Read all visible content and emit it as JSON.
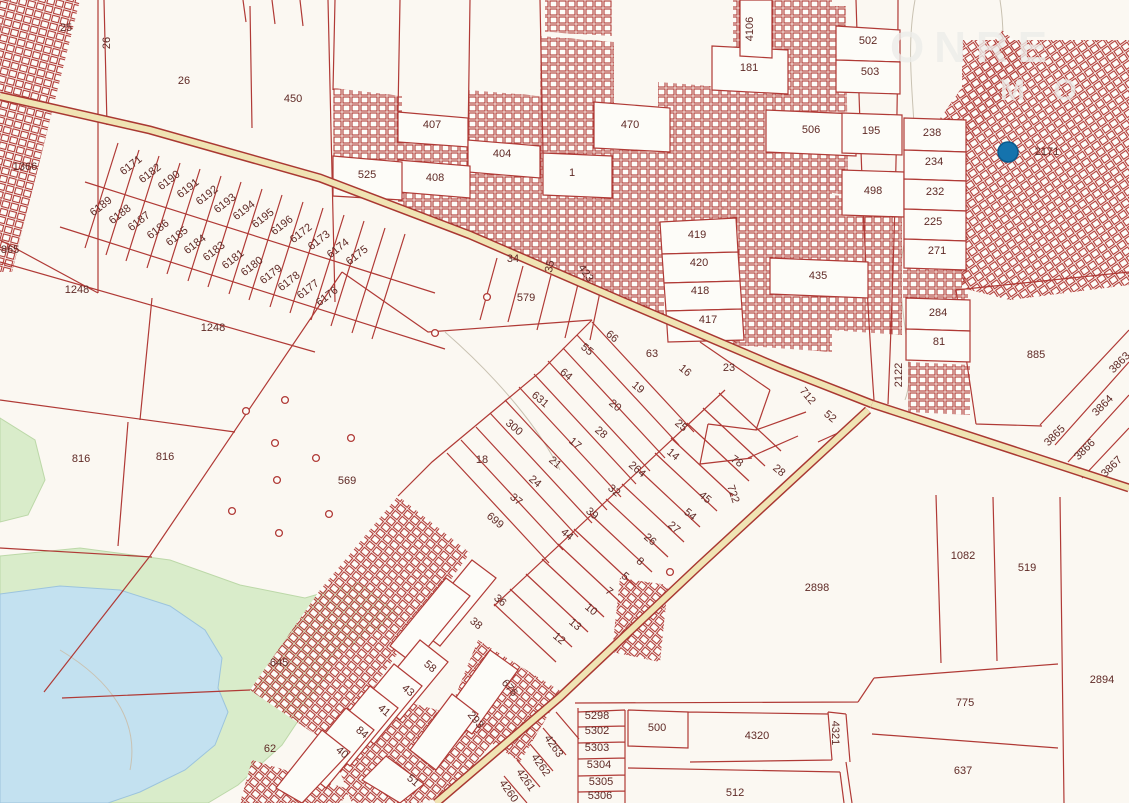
{
  "map": {
    "colors": {
      "background": "#fbf8f2",
      "parcel_line": "#b03a36",
      "label_text": "#5f2a26",
      "road_fill": "#f0e4b4",
      "road_casing": "#a93832",
      "water": "#c3e1f0",
      "vegetation": "#d9ecca",
      "marker_blue": "#1573ad"
    },
    "watermark": {
      "line1": "ONRE",
      "line2": "M O"
    },
    "marker": {
      "x": 1008,
      "y": 152,
      "r": 10,
      "color": "#1573ad"
    },
    "survey_circles": [
      [
        246,
        411
      ],
      [
        285,
        400
      ],
      [
        275,
        443
      ],
      [
        351,
        438
      ],
      [
        316,
        458
      ],
      [
        277,
        480
      ],
      [
        232,
        511
      ],
      [
        329,
        514
      ],
      [
        279,
        533
      ],
      [
        487,
        297
      ],
      [
        670,
        572
      ],
      [
        435,
        333
      ]
    ],
    "labels": [
      {
        "t": "25",
        "x": 66,
        "y": 31
      },
      {
        "t": "26",
        "x": 110,
        "y": 43,
        "r": -90
      },
      {
        "t": "26",
        "x": 184,
        "y": 84
      },
      {
        "t": "450",
        "x": 293,
        "y": 102
      },
      {
        "t": "1366",
        "x": 25,
        "y": 170
      },
      {
        "t": "865",
        "x": 10,
        "y": 253
      },
      {
        "t": "1248",
        "x": 77,
        "y": 293
      },
      {
        "t": "1248",
        "x": 213,
        "y": 331
      },
      {
        "t": "816",
        "x": 81,
        "y": 462
      },
      {
        "t": "816",
        "x": 165,
        "y": 460
      },
      {
        "t": "569",
        "x": 347,
        "y": 484
      },
      {
        "t": "645",
        "x": 279,
        "y": 666
      },
      {
        "t": "62",
        "x": 270,
        "y": 752
      },
      {
        "t": "525",
        "x": 367,
        "y": 178
      },
      {
        "t": "407",
        "x": 432,
        "y": 128
      },
      {
        "t": "404",
        "x": 502,
        "y": 157
      },
      {
        "t": "408",
        "x": 435,
        "y": 181
      },
      {
        "t": "470",
        "x": 630,
        "y": 128
      },
      {
        "t": "1",
        "x": 572,
        "y": 176
      },
      {
        "t": "34",
        "x": 513,
        "y": 262
      },
      {
        "t": "35",
        "x": 553,
        "y": 267,
        "r": -78
      },
      {
        "t": "423",
        "x": 583,
        "y": 275,
        "r": 55
      },
      {
        "t": "579",
        "x": 526,
        "y": 301
      },
      {
        "t": "4106",
        "x": 753,
        "y": 29,
        "r": -90
      },
      {
        "t": "181",
        "x": 749,
        "y": 71
      },
      {
        "t": "502",
        "x": 868,
        "y": 44
      },
      {
        "t": "503",
        "x": 870,
        "y": 75
      },
      {
        "t": "506",
        "x": 811,
        "y": 133
      },
      {
        "t": "195",
        "x": 871,
        "y": 134
      },
      {
        "t": "498",
        "x": 873,
        "y": 194
      },
      {
        "t": "238",
        "x": 932,
        "y": 136
      },
      {
        "t": "234",
        "x": 934,
        "y": 165
      },
      {
        "t": "232",
        "x": 935,
        "y": 195
      },
      {
        "t": "225",
        "x": 933,
        "y": 225
      },
      {
        "t": "271",
        "x": 937,
        "y": 254
      },
      {
        "t": "284",
        "x": 938,
        "y": 316
      },
      {
        "t": "81",
        "x": 939,
        "y": 345
      },
      {
        "t": "2122",
        "x": 902,
        "y": 375,
        "r": -90
      },
      {
        "t": "885",
        "x": 1036,
        "y": 358
      },
      {
        "t": "3863",
        "x": 1122,
        "y": 365,
        "r": -45
      },
      {
        "t": "3864",
        "x": 1105,
        "y": 408,
        "r": -45
      },
      {
        "t": "3865",
        "x": 1057,
        "y": 438,
        "r": -45
      },
      {
        "t": "3866",
        "x": 1087,
        "y": 452,
        "r": -45
      },
      {
        "t": "3867",
        "x": 1114,
        "y": 469,
        "r": -45
      },
      {
        "t": "2171",
        "x": 1047,
        "y": 155
      },
      {
        "t": "419",
        "x": 697,
        "y": 238
      },
      {
        "t": "420",
        "x": 699,
        "y": 266
      },
      {
        "t": "418",
        "x": 700,
        "y": 294
      },
      {
        "t": "417",
        "x": 708,
        "y": 323
      },
      {
        "t": "435",
        "x": 818,
        "y": 279
      },
      {
        "t": "66",
        "x": 610,
        "y": 339,
        "r": 40
      },
      {
        "t": "55",
        "x": 585,
        "y": 352,
        "r": 40
      },
      {
        "t": "63",
        "x": 652,
        "y": 357
      },
      {
        "t": "64",
        "x": 564,
        "y": 377,
        "r": 40
      },
      {
        "t": "16",
        "x": 683,
        "y": 373,
        "r": 40
      },
      {
        "t": "19",
        "x": 636,
        "y": 390,
        "r": 40
      },
      {
        "t": "23",
        "x": 729,
        "y": 371
      },
      {
        "t": "631",
        "x": 538,
        "y": 402,
        "r": 40
      },
      {
        "t": "20",
        "x": 613,
        "y": 408,
        "r": 40
      },
      {
        "t": "25",
        "x": 679,
        "y": 428,
        "r": 40
      },
      {
        "t": "300",
        "x": 512,
        "y": 430,
        "r": 40
      },
      {
        "t": "28",
        "x": 599,
        "y": 435,
        "r": 40
      },
      {
        "t": "17",
        "x": 573,
        "y": 446,
        "r": 40
      },
      {
        "t": "14",
        "x": 671,
        "y": 457,
        "r": 40
      },
      {
        "t": "18",
        "x": 482,
        "y": 463
      },
      {
        "t": "21",
        "x": 553,
        "y": 465,
        "r": 40
      },
      {
        "t": "264",
        "x": 635,
        "y": 472,
        "r": 40
      },
      {
        "t": "24",
        "x": 533,
        "y": 484,
        "r": 40
      },
      {
        "t": "32",
        "x": 612,
        "y": 493,
        "r": 40
      },
      {
        "t": "37",
        "x": 514,
        "y": 502,
        "r": 40
      },
      {
        "t": "45",
        "x": 703,
        "y": 500,
        "r": 40
      },
      {
        "t": "39",
        "x": 590,
        "y": 516,
        "r": 40
      },
      {
        "t": "54",
        "x": 688,
        "y": 517,
        "r": 40
      },
      {
        "t": "699",
        "x": 493,
        "y": 523,
        "r": 40
      },
      {
        "t": "27",
        "x": 672,
        "y": 530,
        "r": 40
      },
      {
        "t": "26",
        "x": 648,
        "y": 542,
        "r": 40
      },
      {
        "t": "44",
        "x": 565,
        "y": 537,
        "r": 40
      },
      {
        "t": "8",
        "x": 638,
        "y": 564,
        "r": 40
      },
      {
        "t": "5",
        "x": 623,
        "y": 579,
        "r": 40
      },
      {
        "t": "7",
        "x": 607,
        "y": 594,
        "r": 40
      },
      {
        "t": "10",
        "x": 589,
        "y": 612,
        "r": 40
      },
      {
        "t": "13",
        "x": 573,
        "y": 627,
        "r": 40
      },
      {
        "t": "12",
        "x": 557,
        "y": 641,
        "r": 40
      },
      {
        "t": "78",
        "x": 735,
        "y": 464,
        "r": 35
      },
      {
        "t": "722",
        "x": 730,
        "y": 495,
        "r": 72
      },
      {
        "t": "28",
        "x": 777,
        "y": 473,
        "r": 40
      },
      {
        "t": "712",
        "x": 805,
        "y": 398,
        "r": 50
      },
      {
        "t": "52",
        "x": 828,
        "y": 419,
        "r": 40
      },
      {
        "t": "36",
        "x": 498,
        "y": 603,
        "r": 40
      },
      {
        "t": "38",
        "x": 474,
        "y": 626,
        "r": 40
      },
      {
        "t": "58",
        "x": 428,
        "y": 669,
        "r": 40
      },
      {
        "t": "43",
        "x": 406,
        "y": 693,
        "r": 40
      },
      {
        "t": "41",
        "x": 382,
        "y": 713,
        "r": 40
      },
      {
        "t": "84",
        "x": 360,
        "y": 735,
        "r": 40
      },
      {
        "t": "40",
        "x": 340,
        "y": 755,
        "r": 40
      },
      {
        "t": "51",
        "x": 411,
        "y": 783,
        "r": 40
      },
      {
        "t": "293",
        "x": 473,
        "y": 722,
        "r": 50
      },
      {
        "t": "676",
        "x": 507,
        "y": 690,
        "r": 50
      },
      {
        "t": "2898",
        "x": 817,
        "y": 591
      },
      {
        "t": "1082",
        "x": 963,
        "y": 559
      },
      {
        "t": "519",
        "x": 1027,
        "y": 571
      },
      {
        "t": "2894",
        "x": 1102,
        "y": 683
      },
      {
        "t": "775",
        "x": 965,
        "y": 706
      },
      {
        "t": "637",
        "x": 963,
        "y": 774
      },
      {
        "t": "5298",
        "x": 597,
        "y": 719
      },
      {
        "t": "5302",
        "x": 597,
        "y": 734
      },
      {
        "t": "5303",
        "x": 597,
        "y": 751
      },
      {
        "t": "5304",
        "x": 599,
        "y": 768
      },
      {
        "t": "5305",
        "x": 601,
        "y": 785
      },
      {
        "t": "5306",
        "x": 600,
        "y": 799
      },
      {
        "t": "500",
        "x": 657,
        "y": 731
      },
      {
        "t": "4320",
        "x": 757,
        "y": 739
      },
      {
        "t": "4321",
        "x": 832,
        "y": 733,
        "r": 90
      },
      {
        "t": "512",
        "x": 735,
        "y": 796
      },
      {
        "t": "4263",
        "x": 551,
        "y": 748,
        "r": 55
      },
      {
        "t": "4262",
        "x": 538,
        "y": 767,
        "r": 55
      },
      {
        "t": "4261",
        "x": 523,
        "y": 782,
        "r": 55
      },
      {
        "t": "4260",
        "x": 506,
        "y": 793,
        "r": 55
      },
      {
        "t": "6171",
        "x": 133,
        "y": 168,
        "r": -38
      },
      {
        "t": "6182",
        "x": 152,
        "y": 176,
        "r": -38
      },
      {
        "t": "6190",
        "x": 171,
        "y": 183,
        "r": -38
      },
      {
        "t": "6191",
        "x": 190,
        "y": 191,
        "r": -38
      },
      {
        "t": "6192",
        "x": 209,
        "y": 198,
        "r": -38
      },
      {
        "t": "6193",
        "x": 227,
        "y": 206,
        "r": -38
      },
      {
        "t": "6194",
        "x": 246,
        "y": 213,
        "r": -38
      },
      {
        "t": "6195",
        "x": 265,
        "y": 221,
        "r": -38
      },
      {
        "t": "6196",
        "x": 284,
        "y": 228,
        "r": -38
      },
      {
        "t": "6172",
        "x": 303,
        "y": 236,
        "r": -38
      },
      {
        "t": "6173",
        "x": 321,
        "y": 243,
        "r": -38
      },
      {
        "t": "6174",
        "x": 340,
        "y": 251,
        "r": -38
      },
      {
        "t": "6175",
        "x": 359,
        "y": 258,
        "r": -38
      },
      {
        "t": "6189",
        "x": 103,
        "y": 209,
        "r": -38
      },
      {
        "t": "6188",
        "x": 122,
        "y": 217,
        "r": -38
      },
      {
        "t": "6187",
        "x": 141,
        "y": 224,
        "r": -38
      },
      {
        "t": "6186",
        "x": 160,
        "y": 232,
        "r": -38
      },
      {
        "t": "6185",
        "x": 179,
        "y": 239,
        "r": -38
      },
      {
        "t": "6184",
        "x": 197,
        "y": 247,
        "r": -38
      },
      {
        "t": "6183",
        "x": 216,
        "y": 254,
        "r": -38
      },
      {
        "t": "6181",
        "x": 235,
        "y": 262,
        "r": -38
      },
      {
        "t": "6180",
        "x": 254,
        "y": 269,
        "r": -38
      },
      {
        "t": "6179",
        "x": 273,
        "y": 277,
        "r": -38
      },
      {
        "t": "6178",
        "x": 291,
        "y": 284,
        "r": -38
      },
      {
        "t": "6177",
        "x": 310,
        "y": 292,
        "r": -38
      },
      {
        "t": "6176",
        "x": 329,
        "y": 299,
        "r": -38
      }
    ]
  }
}
